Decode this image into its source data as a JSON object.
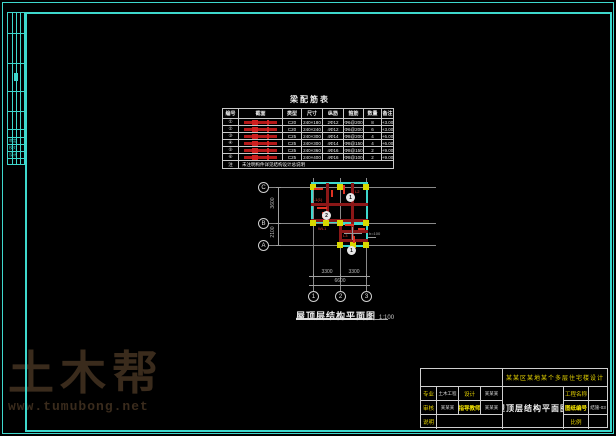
{
  "watermark": {
    "brand": "土木帮",
    "url": "www.tumubong.net"
  },
  "side_strip": {
    "labels": [
      "审定",
      "校对",
      "设计"
    ]
  },
  "table": {
    "title": "梁配筋表",
    "headers": [
      "编号",
      "截面",
      "类型",
      "尺寸",
      "纵筋",
      "箍筋",
      "数量",
      "备注"
    ],
    "rows": [
      [
        "①",
        "",
        "C20",
        "240×180",
        "2Φ12",
        "Φ6@200",
        "8",
        "+3.00"
      ],
      [
        "②",
        "",
        "C20",
        "240×240",
        "4Φ12",
        "Φ6@200",
        "6",
        "+3.00"
      ],
      [
        "③",
        "",
        "C25",
        "240×300",
        "4Φ14",
        "Φ8@200",
        "4",
        "+6.00"
      ],
      [
        "④",
        "",
        "C25",
        "240×300",
        "4Φ14",
        "Φ8@150",
        "4",
        "+6.00"
      ],
      [
        "⑤",
        "",
        "C25",
        "240×360",
        "4Φ16",
        "Φ8@150",
        "2",
        "+9.00"
      ],
      [
        "⑥",
        "",
        "C25",
        "240×400",
        "4Φ16",
        "Φ8@100",
        "2",
        "+9.00"
      ]
    ],
    "footer": {
      "label": "注",
      "text": "未注明构件详见结构设计总说明"
    }
  },
  "plan": {
    "title": "屋顶层结构平面图",
    "scale": "1:100",
    "axis_bottom": [
      "1",
      "2",
      "3"
    ],
    "axis_left": [
      "C",
      "B",
      "A"
    ],
    "dims_bottom": [
      "3300",
      "3300"
    ],
    "dim_total": "6600",
    "dims_left": [
      "3600",
      "2100"
    ],
    "detail_bubbles": [
      "1",
      "2",
      "1"
    ],
    "beam_labels": [
      "L1(1)",
      "L2",
      "WL1",
      "L3"
    ],
    "slab_note": "h=100"
  },
  "title_block": {
    "project": "某某区某地某个多层住宅楼设计",
    "drawing_name": "屋顶层结构平面图",
    "row1": {
      "label1": "专业",
      "value1": "土木工程",
      "label2": "设计",
      "value2": "某某某"
    },
    "row2": {
      "label1": "审核",
      "value1": "某某某",
      "label2": "指导教师",
      "value2": "某某某"
    },
    "row3": {
      "label1": "说明"
    },
    "right": {
      "label1": "工程名称",
      "value1": "",
      "label2": "图纸编号",
      "value2": "结施-03",
      "label3": "比例",
      "value3": ""
    }
  },
  "colors": {
    "frame_teal": "#3ed8cd",
    "beam_dark": "#8b1717",
    "beam_red": "#e03222",
    "column_yellow": "#d8d800",
    "watermark_brown": "#3a2b1c",
    "background": "#000000"
  }
}
